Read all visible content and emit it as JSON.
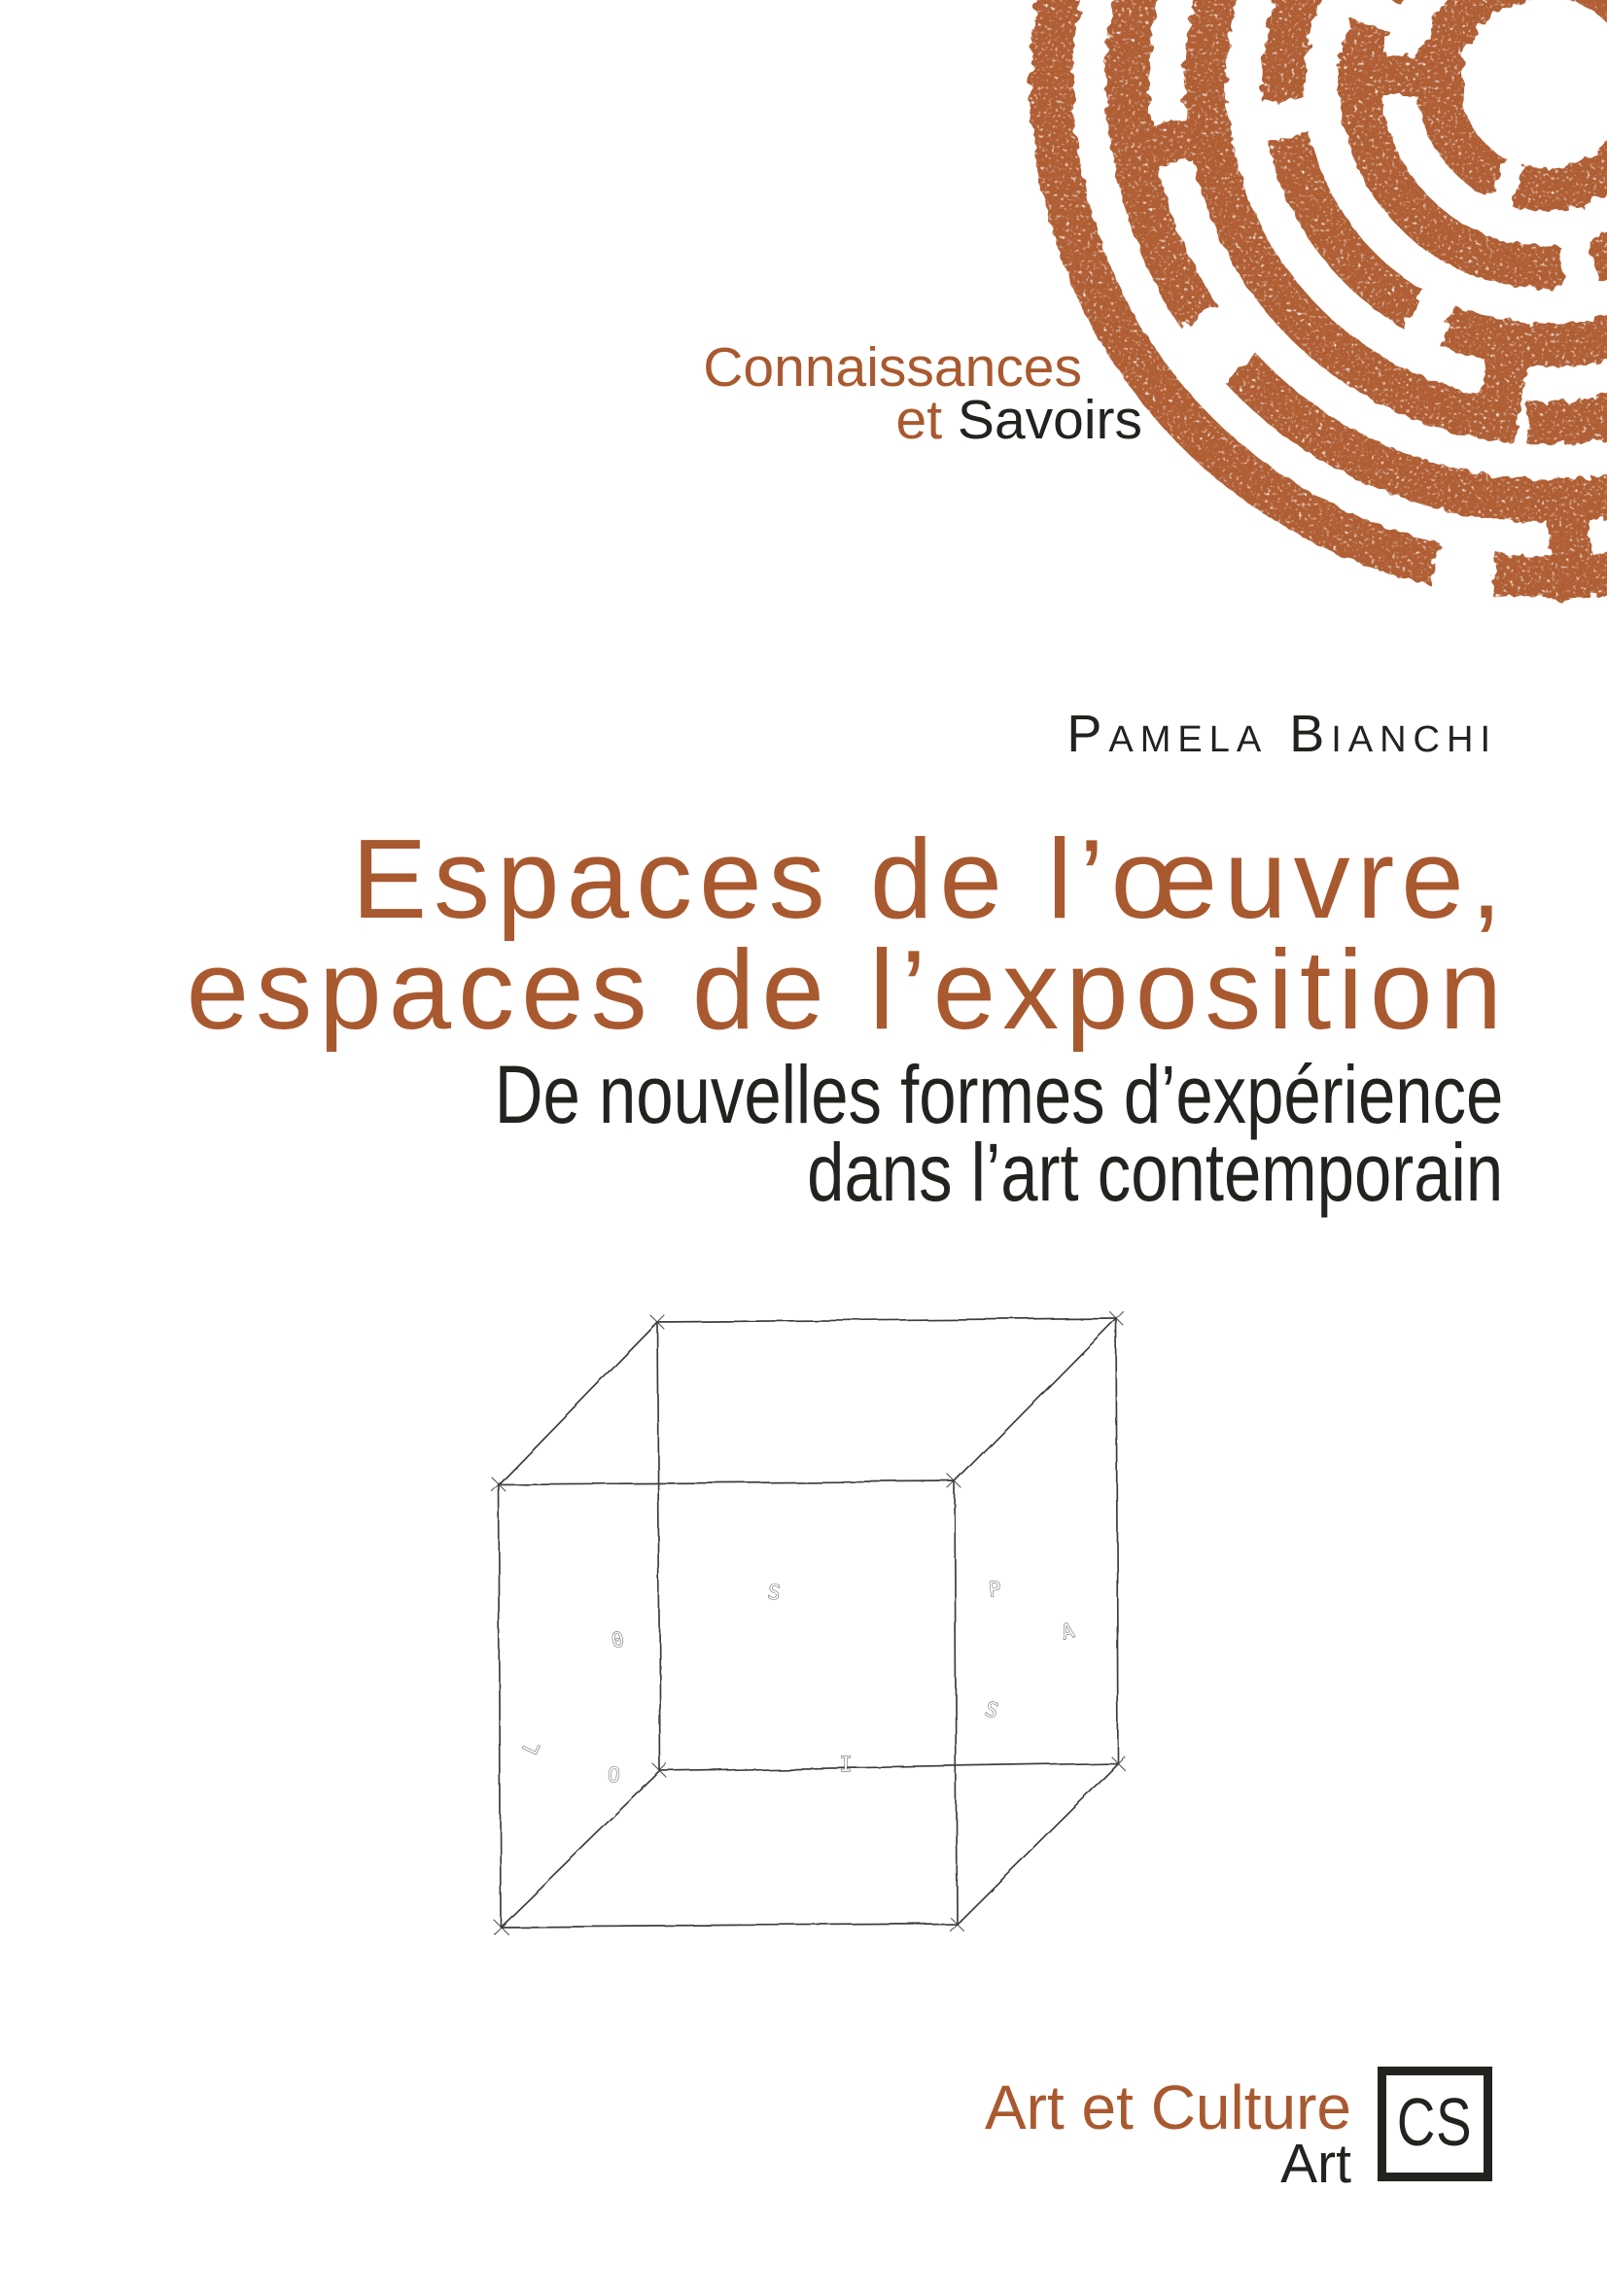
{
  "page": {
    "background": "#ffffff"
  },
  "colors": {
    "terracotta": "#a9592f",
    "labyrinth": "#b05e34",
    "dark": "#24221e",
    "cube": "#3e3e3e"
  },
  "publisher": {
    "line1": "Connaissances",
    "line2_accent": "et",
    "line2_main": "Savoirs"
  },
  "author": {
    "name": "Pamela Bianchi"
  },
  "title": {
    "line1": "Espaces de l’œuvre,",
    "line2": "espaces de l’exposition"
  },
  "subtitle": {
    "line1": "De nouvelles formes d’expérience",
    "line2": "dans l’art contemporain"
  },
  "cube_sketch": {
    "letters": [
      {
        "ch": "S"
      },
      {
        "ch": "P"
      },
      {
        "ch": "0"
      },
      {
        "ch": "A"
      },
      {
        "ch": "L"
      },
      {
        "ch": "S"
      },
      {
        "ch": "O"
      },
      {
        "ch": "I"
      }
    ]
  },
  "footer": {
    "collection": "Art et Culture",
    "category": "Art",
    "publisher_initials": "CS"
  }
}
